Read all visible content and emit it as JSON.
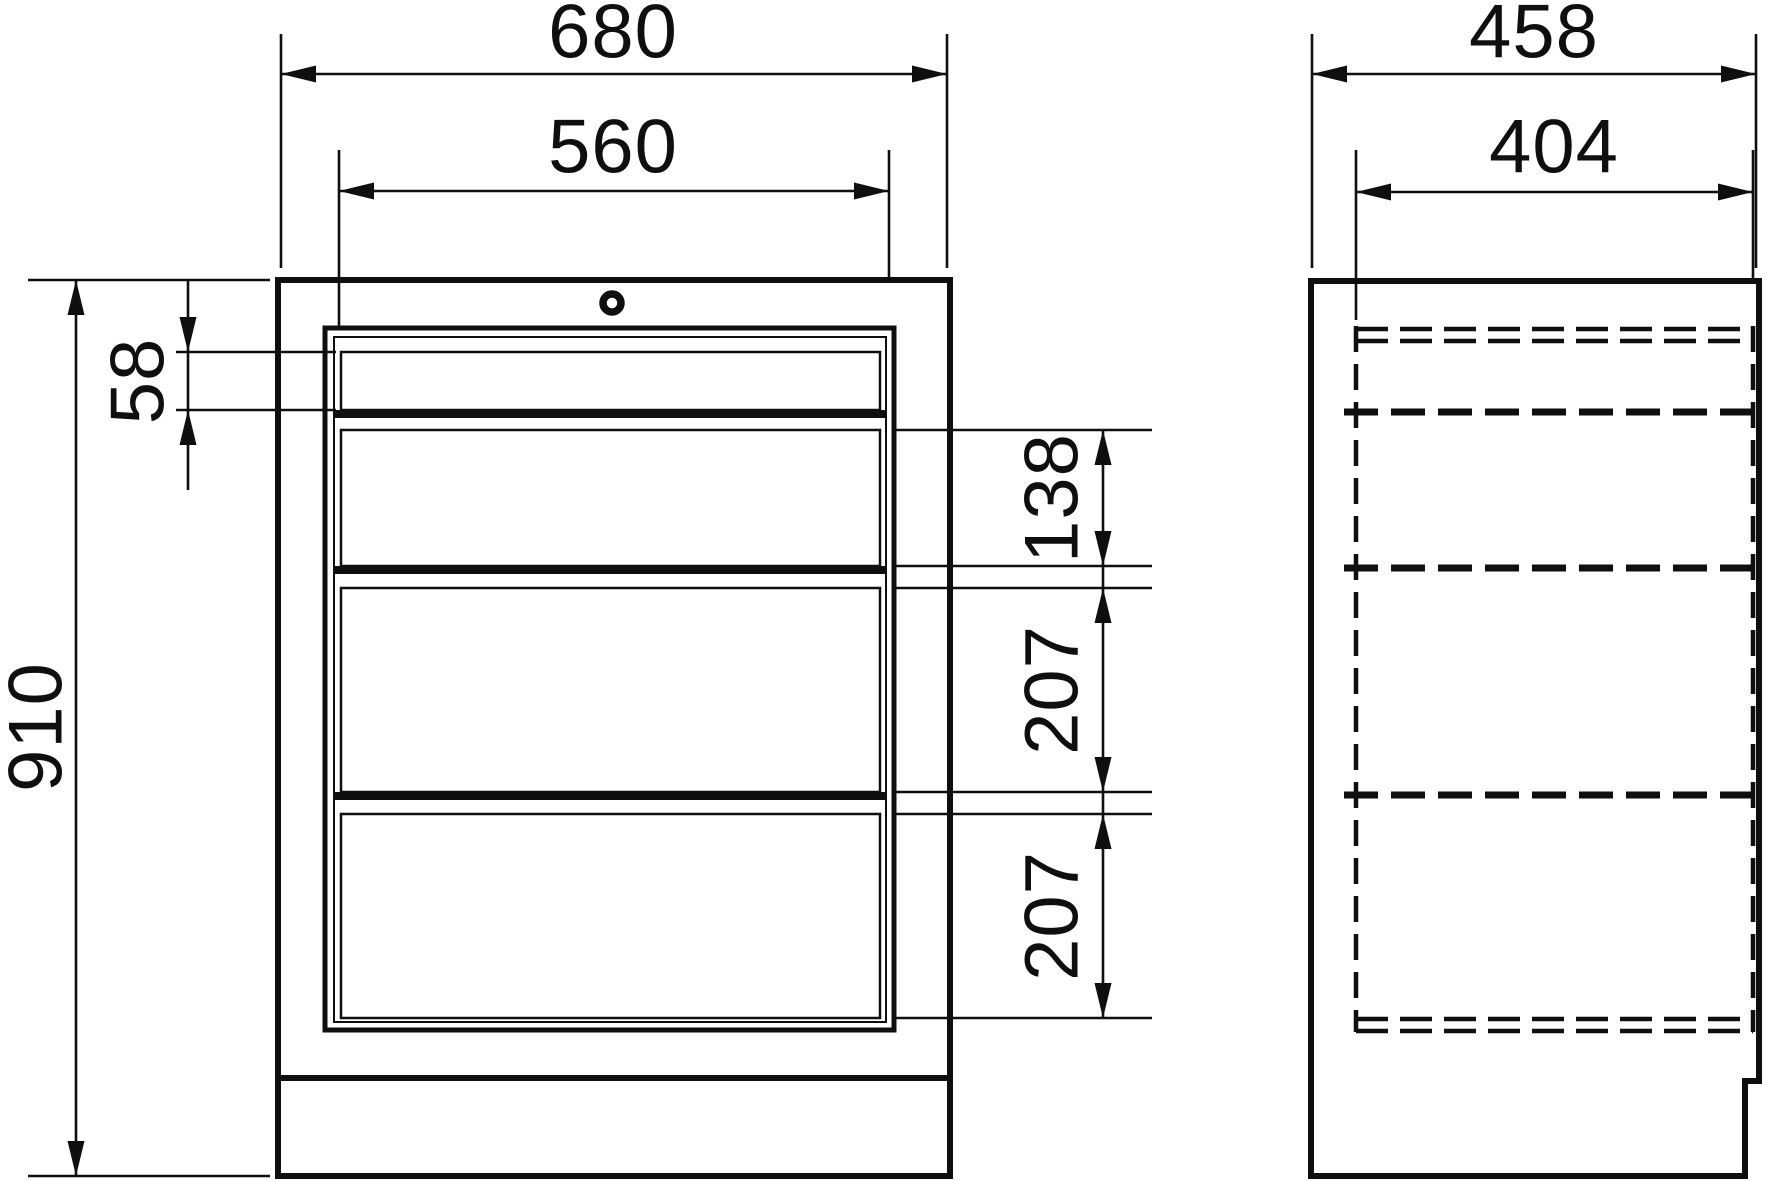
{
  "drawing": {
    "units": "mm",
    "colors": {
      "line": "#0f0f0f",
      "background": "#ffffff"
    },
    "front_view": {
      "dims": {
        "outer_width": "680",
        "drawer_width": "560",
        "outer_height": "910",
        "drawer1_height": "58",
        "drawer2_height": "138",
        "drawer3_height": "207",
        "drawer4_height": "207"
      },
      "drawer_count": 4,
      "icons": {
        "lock": "lock-cylinder-icon"
      }
    },
    "side_view": {
      "dims": {
        "outer_depth": "458",
        "inner_depth": "404"
      },
      "hidden_edges": "dashed"
    }
  }
}
